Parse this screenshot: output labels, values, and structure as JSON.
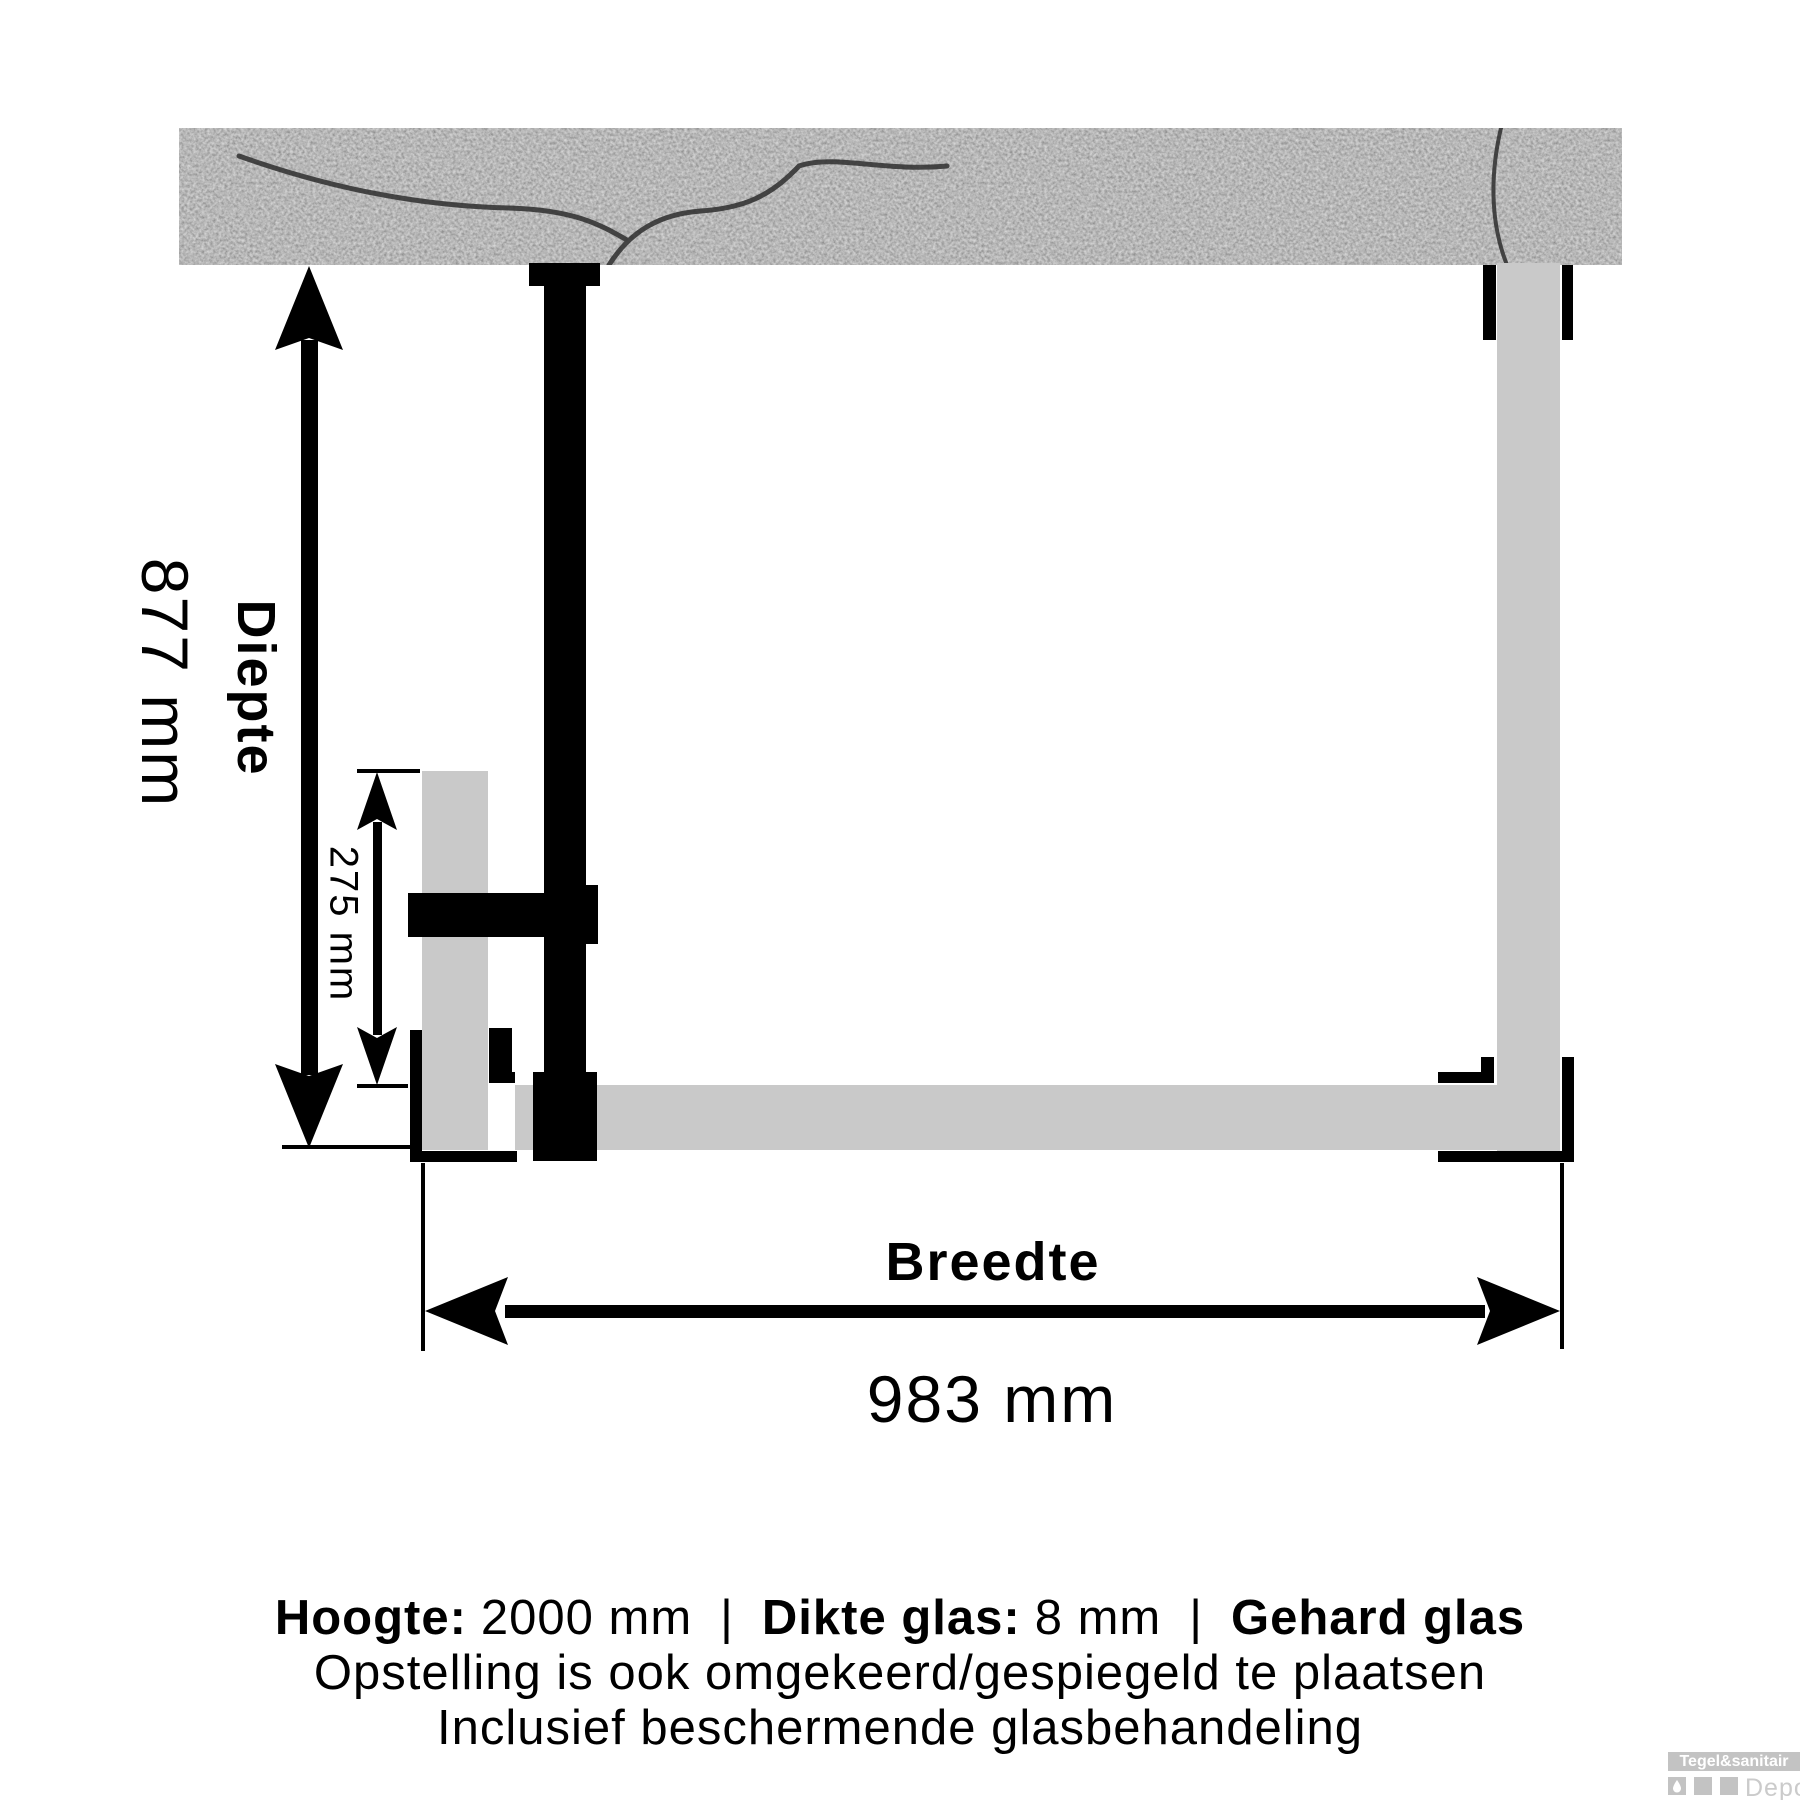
{
  "diagram": {
    "depth": {
      "label": "Diepte",
      "value": "877 mm"
    },
    "inner_depth": {
      "value": "275 mm"
    },
    "width": {
      "label": "Breedte",
      "value": "983 mm"
    },
    "specs": {
      "height_label": "Hoogte:",
      "height_value": "2000 mm",
      "separator": "|",
      "glass_thickness_label": "Dikte glas:",
      "glass_thickness_value": "8 mm",
      "glass_type": "Gehard glas"
    },
    "notes": [
      "Opstelling is ook omgekeerd/gespiegeld te plaatsen",
      "Inclusief beschermende glasbehandeling"
    ]
  },
  "watermark": {
    "brand": "Tegel&sanitair",
    "sub": "Depot",
    "icon": "water-drop-icon"
  },
  "colors": {
    "glass": "#c9c9c9",
    "profile": "#000000",
    "wall_base": "#6f6f6f",
    "watermark_gray": "#c3c3c3"
  }
}
